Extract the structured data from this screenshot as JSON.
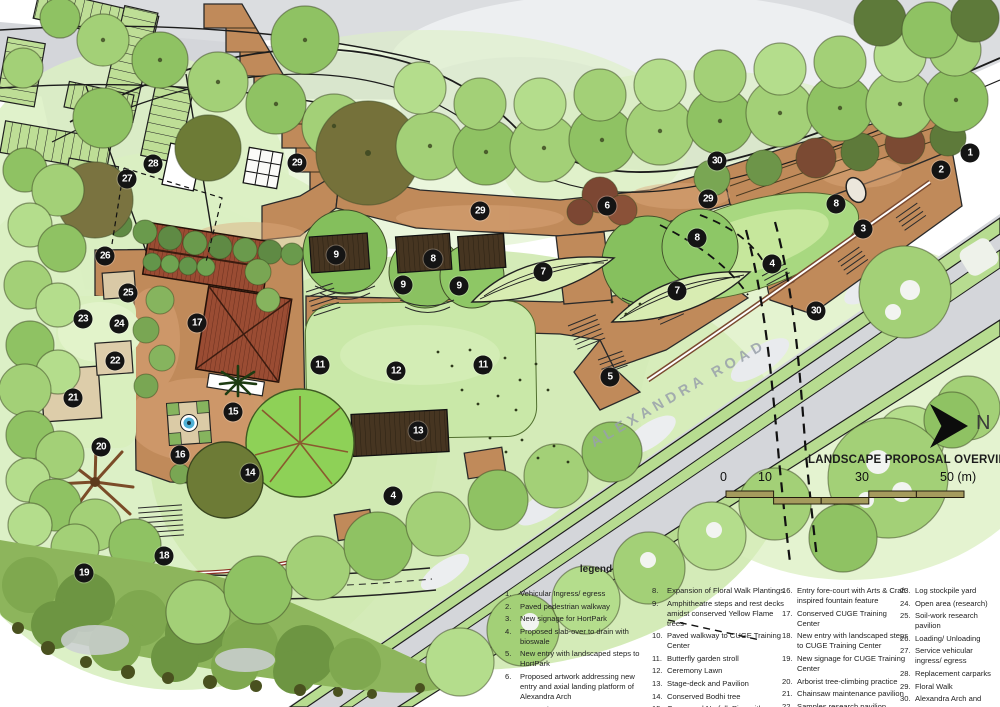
{
  "title": "LANDSCAPE PROPOSAL OVERVIEW",
  "north_label": "N",
  "road_label": "ALEXANDRA ROAD",
  "scale_bar": {
    "labels": [
      "0",
      "10",
      "30",
      "50 (m)"
    ],
    "unit": "m",
    "bar_color": "#a59b5d"
  },
  "legend": {
    "heading": "legend",
    "columns": [
      {
        "items": [
          {
            "num": "1.",
            "text": "Vehicular Ingress/ egress"
          },
          {
            "num": "2.",
            "text": "Paved pedestrian walkway"
          },
          {
            "num": "3.",
            "text": "New signage for HortPark"
          },
          {
            "num": "4.",
            "text": "Proposed slab-over to drain with bioswale"
          },
          {
            "num": "5.",
            "text": "New entry with landscaped steps to HortPark"
          },
          {
            "num": "6.",
            "text": "Proposed artwork addressing new entry and axial landing platform of Alexandra Arch"
          },
          {
            "num": "7.",
            "text": "Ramped access-ways"
          }
        ]
      },
      {
        "items": [
          {
            "num": "8.",
            "text": "Expansion of Floral Walk Plantings"
          },
          {
            "num": "9.",
            "text": "Amphitheatre steps and rest decks amidst conserved Yellow Flame trees"
          },
          {
            "num": "10.",
            "text": "Paved walkway to CUGE Training Center"
          },
          {
            "num": "11.",
            "text": "Butterfly garden stroll"
          },
          {
            "num": "12.",
            "text": "Ceremony Lawn"
          },
          {
            "num": "13.",
            "text": "Stage-deck and Pavilion"
          },
          {
            "num": "14.",
            "text": "Conserved Bodhi tree"
          },
          {
            "num": "15.",
            "text": "Conserved Norfolk Pine with outdoor Heritage Gallery"
          }
        ]
      },
      {
        "items": [
          {
            "num": "16.",
            "text": "Entry fore-court with Arts & Craft inspired fountain feature"
          },
          {
            "num": "17.",
            "text": "Conserved CUGE Training Center"
          },
          {
            "num": "18.",
            "text": "New entry with landscaped steps to CUGE Training Center"
          },
          {
            "num": "19.",
            "text": "New signage for CUGE Training Center"
          },
          {
            "num": "20.",
            "text": "Arborist tree-climbing practice"
          },
          {
            "num": "21.",
            "text": "Chainsaw maintenance pavilion"
          },
          {
            "num": "22.",
            "text": "Samples research pavilion"
          }
        ]
      },
      {
        "items": [
          {
            "num": "23.",
            "text": "Log stockpile yard"
          },
          {
            "num": "24.",
            "text": "Open area (research)"
          },
          {
            "num": "25.",
            "text": "Soil-work research pavilion"
          },
          {
            "num": "26.",
            "text": "Loading/ Unloading"
          },
          {
            "num": "27.",
            "text": "Service vehicular ingress/ egress"
          },
          {
            "num": "28.",
            "text": "Replacement carparks"
          },
          {
            "num": "29.",
            "text": "Floral Walk"
          },
          {
            "num": "30.",
            "text": "Alexandra Arch and ramp ways"
          }
        ]
      }
    ]
  },
  "markers": [
    {
      "n": "1",
      "x": 970,
      "y": 153
    },
    {
      "n": "2",
      "x": 941,
      "y": 170
    },
    {
      "n": "3",
      "x": 863,
      "y": 229
    },
    {
      "n": "4",
      "x": 772,
      "y": 264
    },
    {
      "n": "4",
      "x": 393,
      "y": 496
    },
    {
      "n": "5",
      "x": 610,
      "y": 377
    },
    {
      "n": "6",
      "x": 607,
      "y": 206
    },
    {
      "n": "7",
      "x": 677,
      "y": 291
    },
    {
      "n": "7",
      "x": 543,
      "y": 272
    },
    {
      "n": "8",
      "x": 836,
      "y": 204
    },
    {
      "n": "8",
      "x": 697,
      "y": 238
    },
    {
      "n": "8",
      "x": 433,
      "y": 259
    },
    {
      "n": "9",
      "x": 336,
      "y": 255
    },
    {
      "n": "9",
      "x": 403,
      "y": 285
    },
    {
      "n": "9",
      "x": 459,
      "y": 286
    },
    {
      "n": "11",
      "x": 320,
      "y": 365
    },
    {
      "n": "11",
      "x": 483,
      "y": 365
    },
    {
      "n": "12",
      "x": 396,
      "y": 371
    },
    {
      "n": "13",
      "x": 418,
      "y": 431
    },
    {
      "n": "14",
      "x": 250,
      "y": 473
    },
    {
      "n": "15",
      "x": 233,
      "y": 412
    },
    {
      "n": "16",
      "x": 180,
      "y": 455
    },
    {
      "n": "17",
      "x": 197,
      "y": 323
    },
    {
      "n": "18",
      "x": 164,
      "y": 556
    },
    {
      "n": "19",
      "x": 84,
      "y": 573
    },
    {
      "n": "20",
      "x": 101,
      "y": 447
    },
    {
      "n": "21",
      "x": 73,
      "y": 398
    },
    {
      "n": "22",
      "x": 115,
      "y": 361
    },
    {
      "n": "23",
      "x": 83,
      "y": 319
    },
    {
      "n": "24",
      "x": 119,
      "y": 324
    },
    {
      "n": "25",
      "x": 128,
      "y": 293
    },
    {
      "n": "26",
      "x": 105,
      "y": 256
    },
    {
      "n": "27",
      "x": 127,
      "y": 179
    },
    {
      "n": "28",
      "x": 153,
      "y": 164
    },
    {
      "n": "29",
      "x": 297,
      "y": 163
    },
    {
      "n": "29",
      "x": 480,
      "y": 211
    },
    {
      "n": "29",
      "x": 708,
      "y": 199
    },
    {
      "n": "30",
      "x": 717,
      "y": 161
    },
    {
      "n": "30",
      "x": 816,
      "y": 311
    }
  ],
  "colors": {
    "marker_bg": "#141414",
    "plaza": "#c08a5a",
    "canopy_light": "#a3d077",
    "canopy_mid": "#8fc263",
    "road_gray": "#d6d8dc",
    "lawn": "#c9e8a8",
    "scale_bar": "#a59b5d"
  }
}
